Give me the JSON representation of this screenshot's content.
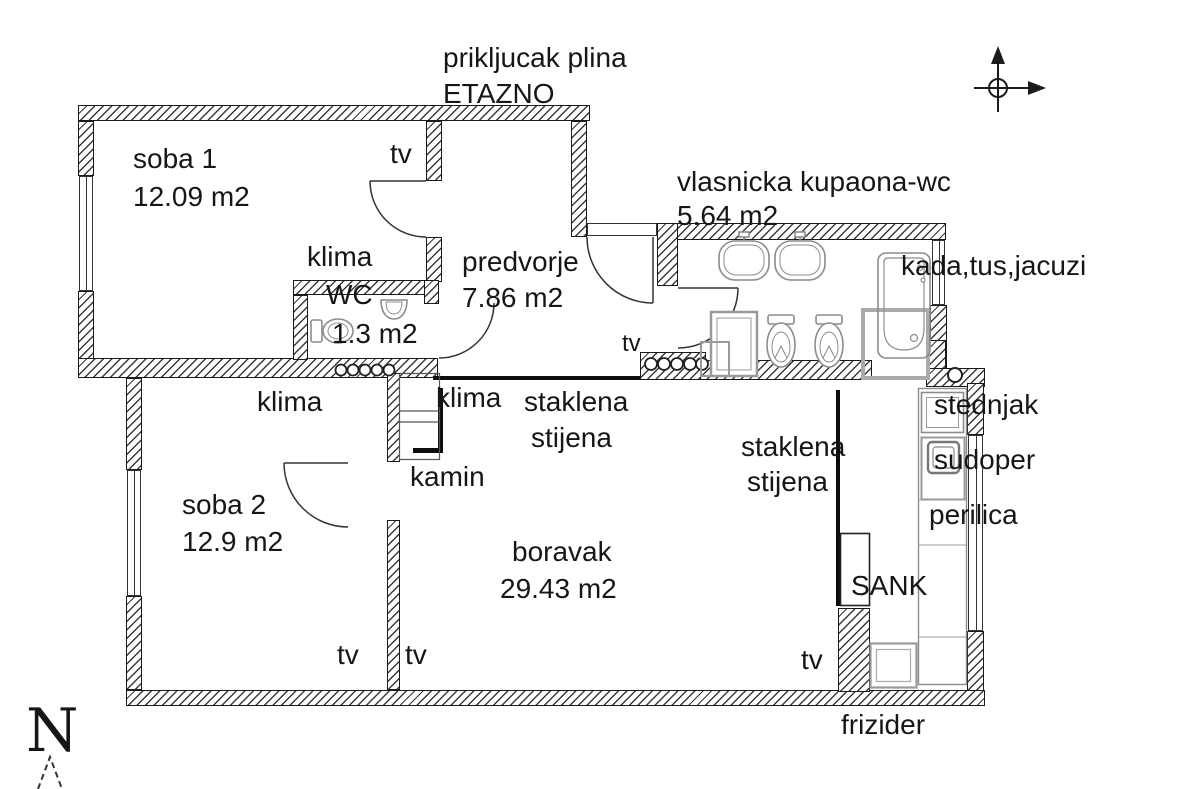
{
  "title": "apartment floor plan",
  "rooms": {
    "soba1": {
      "name": "soba 1",
      "area": "12.09 m2"
    },
    "soba2": {
      "name": "soba 2",
      "area": "12.9 m2"
    },
    "predvorje": {
      "name": "predvorje",
      "area": "7.86 m2"
    },
    "wc": {
      "name": "WC",
      "area": "1.3 m2"
    },
    "kupaona": {
      "name": "vlasnicka kupaona-wc",
      "area": "5.64 m2"
    },
    "boravak": {
      "name": "boravak",
      "area": "29.43 m2"
    }
  },
  "annotations": {
    "gas_connection": "prikljucak plina",
    "heating": "ETAZNO",
    "tv": "tv",
    "klima": "klima",
    "kamin": "kamin",
    "glass_wall": {
      "line1": "staklena",
      "line2": "stijena"
    },
    "bath_equipment": "kada,tus,jacuzi",
    "stove": "stednjak",
    "kitchen_sink": "sudoper",
    "washing_machine": "perilica",
    "bar": "SANK",
    "fridge": "frizider",
    "north": "N"
  },
  "icons": [
    "north-arrow",
    "compass",
    "bathtub",
    "shower-tray",
    "wash-basin",
    "toilet",
    "stove",
    "kitchen-sink",
    "fridge",
    "radiator-circles",
    "fireplace",
    "door-arc"
  ],
  "colors": {
    "ink": "#161616",
    "fixture_gray": "#909090",
    "wall_hatch": "#3a3a3a"
  }
}
